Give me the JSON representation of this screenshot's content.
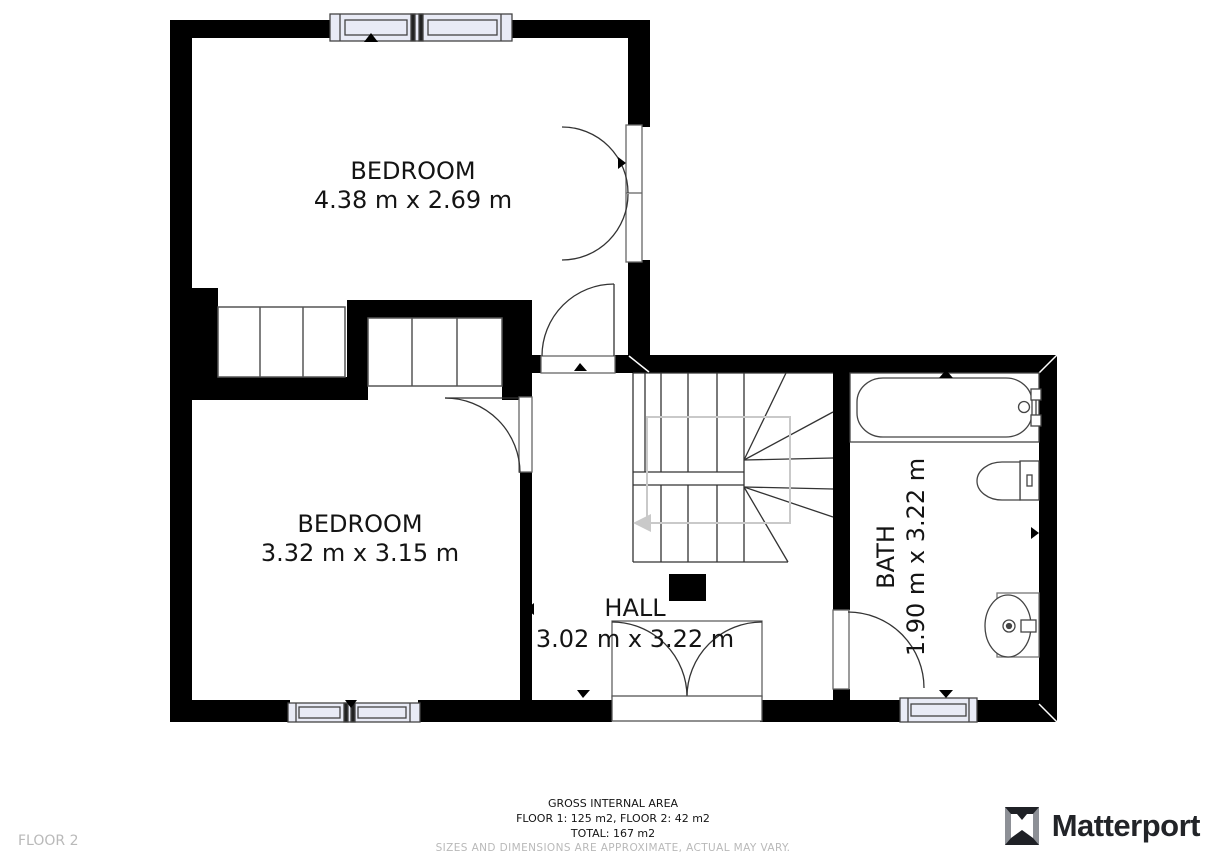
{
  "plan": {
    "rooms": [
      {
        "id": "bedroom-1",
        "name": "BEDROOM",
        "dims": "4.38 m x 2.69 m"
      },
      {
        "id": "bedroom-2",
        "name": "BEDROOM",
        "dims": "3.32 m x 3.15 m"
      },
      {
        "id": "hall",
        "name": "HALL",
        "dims": "3.02 m x 3.22 m"
      },
      {
        "id": "bath",
        "name": "BATH",
        "dims": "1.90 m x 3.22 m"
      }
    ]
  },
  "footer": {
    "gross_area_title": "GROSS INTERNAL AREA",
    "floors_line": "FLOOR 1: 125 m2, FLOOR 2: 42 m2",
    "total_line": "TOTAL: 167 m2",
    "disclaimer": "SIZES AND DIMENSIONS ARE APPROXIMATE, ACTUAL MAY VARY.",
    "floor_label": "FLOOR 2"
  },
  "branding": {
    "name": "Matterport"
  },
  "colors": {
    "wall": "#000000",
    "window_fill": "#e9ebf6",
    "outline": "#3a3a3a",
    "stair_guide": "#c9c9c9",
    "muted_text": "#b9b9b9",
    "logo_text": "#222428"
  }
}
